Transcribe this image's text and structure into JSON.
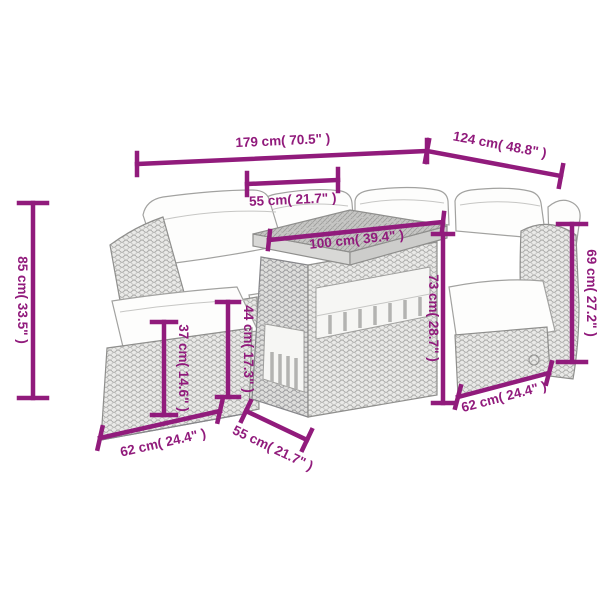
{
  "colors": {
    "dimension": "#911b7c",
    "furniture_outline": "#8f8f8d",
    "cushion": "#fdfdfc",
    "background": "#ffffff"
  },
  "dimensions": {
    "total_width": "179 cm( 70.5\" )",
    "total_depth": "124 cm( 48.8\" )",
    "seat_width": "55 cm( 21.7\" )",
    "table_length": "100 cm( 39.4\" )",
    "total_height": "85 cm( 33.5\" )",
    "backrest_height": "69 cm( 27.2\" )",
    "table_height": "73 cm( 28.7\" )",
    "footstool_height": "37 cm( 14.6\" )",
    "seat_height": "44 cm( 17.3\" )",
    "footstool_width": "62 cm( 24.4\" )",
    "table_width": "55 cm( 21.7\" )",
    "seat_depth": "62 cm( 24.4\" )"
  }
}
